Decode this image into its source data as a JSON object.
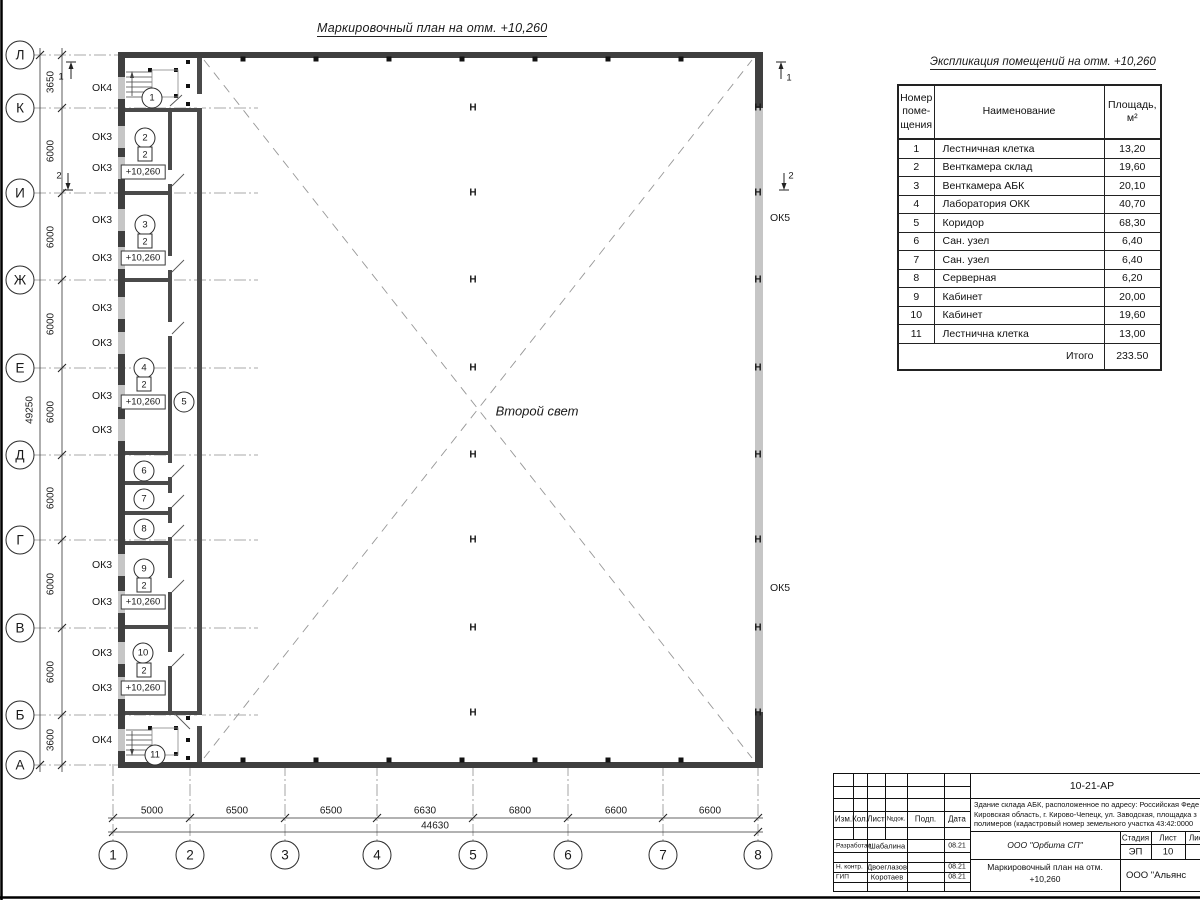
{
  "plan": {
    "title": "Маркировочный план на отм. +10,260",
    "second_light": "Второй свет",
    "left_axes": [
      "Л",
      "К",
      "И",
      "Ж",
      "Е",
      "Д",
      "Г",
      "В",
      "Б",
      "А"
    ],
    "bottom_axes": [
      "1",
      "2",
      "3",
      "4",
      "5",
      "6",
      "7",
      "8"
    ],
    "left_dims": [
      "3650",
      "6000",
      "6000",
      "6000",
      "6000",
      "6000",
      "6000",
      "6000",
      "3600"
    ],
    "left_total": "49250",
    "bottom_dims": [
      "5000",
      "6500",
      "6500",
      "6630",
      "6800",
      "6600",
      "6600"
    ],
    "bottom_total": "44630",
    "left_window_labels": [
      "ОК4",
      "ОК3",
      "ОК3",
      "ОК3",
      "ОК3",
      "ОК3",
      "ОК3",
      "ОК3",
      "ОК3",
      "ОК3",
      "ОК3",
      "ОК3",
      "ОК3",
      "ОК4"
    ],
    "right_window_labels": [
      "ОК5",
      "ОК5"
    ],
    "section_marks": [
      "1",
      "2",
      "1",
      "2"
    ],
    "column_symbol": "Н",
    "floor_mark": "2",
    "elevation_mark": "+10,260",
    "room_numbers": [
      "1",
      "2",
      "3",
      "4",
      "5",
      "6",
      "7",
      "8",
      "9",
      "10",
      "11"
    ],
    "rooms_with_floor_mark": [
      "2",
      "3",
      "4",
      "9",
      "10"
    ]
  },
  "table": {
    "title": "Экспликация помещений на отм. +10,260",
    "col_headers": [
      "Номер\nпоме-\nщения",
      "Наименование",
      "Площадь,\nм²"
    ],
    "rows": [
      [
        "1",
        "Лестничная клетка",
        "13,20"
      ],
      [
        "2",
        "Венткамера склад",
        "19,60"
      ],
      [
        "3",
        "Венткамера АБК",
        "20,10"
      ],
      [
        "4",
        "Лаборатория ОКК",
        "40,70"
      ],
      [
        "5",
        "Коридор",
        "68,30"
      ],
      [
        "6",
        "Сан. узел",
        "6,40"
      ],
      [
        "7",
        "Сан. узел",
        "6,40"
      ],
      [
        "8",
        "Серверная",
        "6,20"
      ],
      [
        "9",
        "Кабинет",
        "20,00"
      ],
      [
        "10",
        "Кабинет",
        "19,60"
      ],
      [
        "11",
        "Лестнична клетка",
        "13,00"
      ]
    ],
    "total_label": "Итого",
    "total_value": "233.50"
  },
  "stamp": {
    "doc_number": "10-21-АР",
    "address_lines": [
      "Здание склада АБК, расположенное по адресу: Российская Феде",
      "Кировская область, г. Кирово-Чепецк, ул. Заводская, площадка з",
      "полимеров (кадастровый номер земельного участка 43:42:0000"
    ],
    "grid_headers": [
      "Изм.",
      "Кол.",
      "Лист",
      "№док.",
      "Подп.",
      "Дата"
    ],
    "staff": [
      {
        "role": "Разработал",
        "name": "Шабалина",
        "date": "08.21"
      },
      {
        "role": "Н. контр.",
        "name": "Двоеглазов",
        "date": "08.21"
      },
      {
        "role": "ГИП",
        "name": "Коротаев",
        "date": "08.21"
      }
    ],
    "org1": "ООО \"Орбита СП\"",
    "stage_headers": [
      "Стадия",
      "Лист",
      "Листов"
    ],
    "stage_values": [
      "ЭП",
      "10",
      "1"
    ],
    "sheet_title1": "Маркировочный план на отм.",
    "sheet_title2": "+10,260",
    "org2": "ООО \"Альянс"
  }
}
